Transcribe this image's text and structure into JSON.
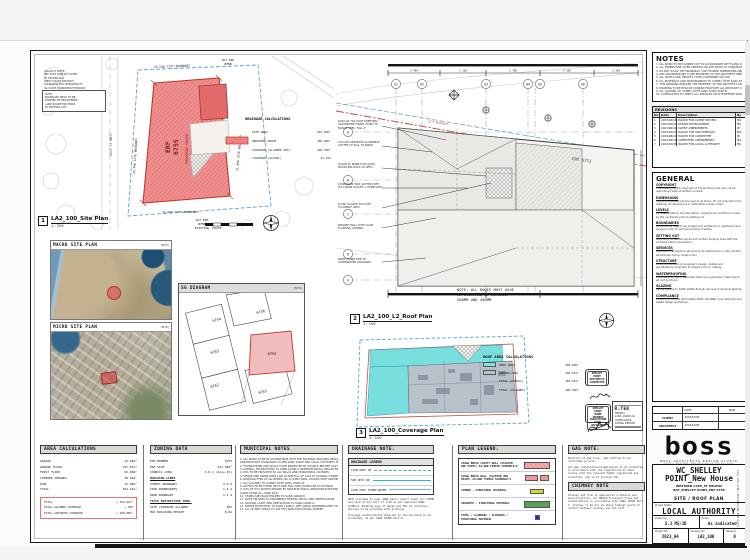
{
  "colors": {
    "accent_red": "#ef8686",
    "red_border": "#c0392b",
    "cyan": "#7fe0e0",
    "gray_area": "#b9c2cb",
    "legend_yellow": "#d6d636",
    "legend_green": "#57a257",
    "legend_blue": "#2929cc",
    "boundary_blue": "#5aa0d8"
  },
  "titleblock": {
    "notes": {
      "title": "NOTES",
      "lines": [
        "1. ALL WORK TO BE CARRIED OUT IN ACCORDANCE WITH SANS 10400 AND THE NBR.",
        "2. ALL DIMENSIONS TO BE VERIFIED ON SITE PRIOR TO CONSTRUCTION.",
        "3. DO NOT SCALE OFF DRAWINGS. USE FIGURED DIMENSIONS ONLY.",
        "4. ANY DISCREPANCIES TO BE REPORTED TO THE ARCHITECT IMMEDIATELY.",
        "5. ALL LEVELS AND HEIGHTS TO BE CONFIRMED ON SITE.",
        "6. ALL MATERIALS AND WORKMANSHIP TO COMPLY WITH SANS SPECIFICATIONS.",
        "7. THIS DRAWING REMAINS THE PROPERTY OF THE ARCHITECT AND MAY NOT BE COPIED.",
        "8. DRAWING TO BE READ IN CONJUNCTION WITH ALL RELEVANT CONSULTANT DRAWINGS.",
        "9. ALL GLAZING TO COMPLY WITH SANS 10400 PART N.",
        "10. CONTRACTOR TO VERIFY ALL SERVICES ON SITE BEFORE WORK COMMENCES."
      ]
    },
    "revisions": {
      "title": "REVISIONS",
      "columns": [
        "No.",
        "Date",
        "Description",
        "By"
      ],
      "rows": [
        [
          "1",
          "2023/04/18",
          "ISSUED FOR CLIENT REVIEW",
          "MS"
        ],
        [
          "2",
          "2023/05/22",
          "DESIGN DEVELOPMENT",
          "MS"
        ],
        [
          "3",
          "2023/06/14",
          "CLIENT AMENDMENTS",
          "JB"
        ],
        [
          "4",
          "2023/07/03",
          "ISSUED FOR SDP APPROVAL",
          "MS"
        ],
        [
          "5",
          "2023/08/21",
          "ISSUED FOR COMMITTEE",
          "JB"
        ],
        [
          "6",
          "2023/09/12",
          "COMMITTEE AMENDMENTS",
          "MS"
        ],
        [
          "7",
          "2023/10/05",
          "ISSUED FOR LOCAL AUTHORITY",
          "MS"
        ]
      ]
    },
    "general": {
      "title": "GENERAL",
      "paras": [
        {
          "h": "COPYRIGHT",
          "b": "This drawing is the copyright of the architect and may not be reproduced without written consent."
        },
        {
          "h": "DIMENSIONS",
          "b": "Figured dimensions to be used at all times. Do not scale from this drawing. All dimensions in millimetres unless noted."
        },
        {
          "h": "LEVELS",
          "b": "All levels relate to the site datum. Levels to be confirmed on site by the contractor prior to setting out."
        },
        {
          "h": "BOUNDARIES",
          "b": "All boundary pegs to be located and verified by a registered land surveyor prior to commencement of works."
        },
        {
          "h": "SETTING OUT",
          "b": "Contractor to set out works and confirm building lines with the architect before excavation."
        },
        {
          "h": "SERVICES",
          "b": "Positions of all existing services to be determined on site. Protect all services during construction."
        },
        {
          "h": "STRUCTURE",
          "b": "All structural work to engineer's design, details and specifications. Engineer to inspect prior to casting."
        },
        {
          "h": "WATERPROOFING",
          "b": "All waterproofing to specialist detail and guarantee. Flashings to all roof junctions."
        },
        {
          "h": "GLAZING",
          "b": "Safety glazing to SANS 10400-N at all doors and low level glazing."
        },
        {
          "h": "COMPLIANCE",
          "b": "All work to comply with SANS 10400, the NBR, local authority and estate design guidelines."
        }
      ],
      "table": {
        "rows": [
          [
            "",
            "DATE",
            "SIGN"
          ],
          [
            "CLIENT",
            "2023/10/05",
            ""
          ],
          [
            "ARCHITECT",
            "2023/10/05",
            ""
          ]
        ]
      }
    },
    "brand": {
      "logo": "boss",
      "tagline": "BOSS ARCHITECTS DESIGN STUDIO",
      "contact": "STUDIO_WESTERN CAPE_INFO@BOSS_082 000 0000"
    },
    "project": {
      "title1": "WC_SHELLEY",
      "title2": "POINT_New House",
      "address1": "WESTERN CAPE_ST HELENA",
      "address2": "BAY_SHELLEY POINT_ERF 6755",
      "sheet_name": "SITE / ROOF PLAN",
      "status_label": "Project Status",
      "status": "LOCAL AUTHORITY",
      "drawn_label": "Drawn by:",
      "drawn": "S.J  MS/JB",
      "scale_label": "Scale:",
      "scale": "As indicated",
      "projno_label": "Project No.",
      "projno": "2023_04",
      "dwgno_label": "Drawing No.",
      "dwgno": "LA2_100",
      "rev_label": "Revision:",
      "rev": "0"
    },
    "side_text": "LA2_100_SITE / ROOF PLAN_ERF 6755"
  },
  "views": {
    "site": {
      "num": "1",
      "name": "LA2_100_Site Plan",
      "scale": "1 : 200",
      "erf": "ERF",
      "erf_no": "6755",
      "erf_sub": "PROPOSED HOUSE",
      "b_top": "16.54m CITY BOUNDARY",
      "b_bottom": "16.66m CITY BOUNDARY",
      "b_left": "25.49m SITE BOUNDARY",
      "b_right": "21.49m SITE BOUNDARY",
      "adj_top1": "ADJ ERF",
      "adj_top2": "6756",
      "adj_bot1": "ADJ ERF",
      "adj_bot2": "6754",
      "adj_bot3": "EXISTING",
      "adj_bot4": "HOUSE",
      "road": "GOLF ST WEST",
      "corner_lines": [
        "LOCALITY NOTE:",
        "ERF 6755 SHELLEY POINT",
        "ST HELENA BAY",
        "WEST COAST DISTRICT",
        "SALDANHA BAY MUNICIPALITY",
        "SG CODE C0660000675500000"
      ],
      "boxed_note": [
        "NOTE:",
        "BOUNDARY PEGS TO BE",
        "VERIFIED BY REGISTERED",
        "LAND SURVEYOR PRIOR",
        "TO SETTING OUT."
      ],
      "legend": {
        "title": "DRAINAGE CALCULATIONS",
        "rows": [
          [
            "SITE AREA",
            "641.00m²"
          ],
          [
            "PROPOSED HOUSE",
            "395.00m²"
          ],
          [
            "COVERAGE (ALLOWED 50%)",
            "320.50m²"
          ],
          [
            "COVERAGE (ACTUAL)",
            "41.07%"
          ]
        ]
      }
    },
    "macro": {
      "title": "MACRO SITE PLAN",
      "nts": "(NTS)"
    },
    "micro": {
      "title": "MICRO SITE PLAN",
      "nts": "(NTS)"
    },
    "sg": {
      "title": "SG DIAGRAM",
      "nts": "(NTS)",
      "parcels": {
        "p1": "6754",
        "p2": "6756",
        "p3": "6763",
        "p4": "6762",
        "p5": "6761",
        "main": "6755"
      }
    },
    "roof": {
      "num": "2",
      "name": "LA2_100_L2_Roof Plan",
      "scale": "1 : 100",
      "note_lines": [
        "NOTE: ALL ROOFS MUST HAVE",
        "AN OVERHANG OF BETWEEN",
        "200MM AND 450MM"
      ],
      "grid_cols": [
        "01",
        "02",
        "03",
        "04",
        "05",
        "06"
      ],
      "grid_rows": [
        "A",
        "B",
        "C",
        "D",
        "E"
      ],
      "erf_label": "ERF 6753",
      "boundary_label": "SITE BOUNDARY",
      "dims": [
        "2 450",
        "3 120",
        "5 780",
        "4 100",
        "2 300"
      ],
      "callouts": [
        [
          "KLIP-LOK 700 ROOF SHEETING,",
          "COLORBOND FINISH, FIXED TO",
          "MANUF. SPEC. FALL 2°"
        ],
        [
          "125x100 SEAMLESS ALUMINIUM",
          "GUTTER TO FALL TO RWDP"
        ],
        [
          "SOLAR PV PANELS ON ALUM.",
          "MOUNTING RAILS TO SPEC."
        ],
        [
          "CONCEALED BOX GUTTER WITH",
          "FULL-BORE OUTLET + OVERFLOW"
        ],
        [
          "FLUSH GLAZED SKYLIGHT",
          "TO MANUF. SPEC."
        ],
        [
          "PARAPET WALL WITH ALUM.",
          "FLASHING CAPPING"
        ],
        [
          "RWDP DOWN PIPE TO",
          "STORMWATER SOAKAWAY"
        ]
      ]
    },
    "coverage": {
      "num": "3",
      "name": "LA2_100_Coverage Plan",
      "scale": "1 : 100"
    },
    "roof_area": {
      "title": "ROOF AREA CALCULATIONS",
      "rows": [
        {
          "sw": "cy",
          "label": "ROOF AREA",
          "value": "258.00m²"
        },
        {
          "sw": "gr",
          "label": "GROUND AREA",
          "value": "136.61m²"
        },
        {
          "sw": "none",
          "label": "TOTAL (ACTUAL)",
          "value": "394.61m²"
        },
        {
          "sw": "none",
          "label": "TOTAL (ALLOWED)",
          "value": "320.50m²"
        }
      ]
    }
  },
  "stamps": {
    "s1": [
      "SHELLEY POINT",
      "AESTHETICS",
      "COMMITTEE"
    ],
    "s2": [
      "SHELLEY POINT",
      "HOME OWNERS",
      "ASSOCIATION",
      "DATE: 2023/10/05"
    ],
    "rtek": {
      "logo": "R:TEK",
      "lines": [
        "ENERGY",
        "SANS 10400-XA",
        "COMPLIANCE",
        "RATING REPORT"
      ]
    }
  },
  "tables": {
    "area": {
      "title": "AREA CALCULATIONS",
      "rows": [
        [
          "GARAGE",
          "44.66m²"
        ],
        [
          "GROUND FLOOR",
          "197.87m²"
        ],
        [
          "FIRST FLOOR",
          "92.08m²"
        ],
        [
          "COVERED VERANDA",
          "38.92m²"
        ],
        [
          "POOL",
          "21.08m²"
        ],
        [
          "TOTAL",
          "394.61m²"
        ]
      ],
      "total_rows": [
        [
          "TOTAL",
          "+ 394.61m²"
        ],
        [
          "TOTAL ALLOWED COVERAGE",
          "+ 50%"
        ],
        [
          "TOTAL ACHIEVED COVERAGE",
          "+ 258.00m²"
        ]
      ]
    },
    "zoning": {
      "title": "ZONING DATA",
      "rows": [
        [
          "ERF NUMBER",
          "6755"
        ],
        [
          "ERF SIZE",
          "641.00m²"
        ],
        [
          "COUNCIL COND.",
          "S.R.1 (Zone 01)"
        ],
        [
          "BUILDING LINES",
          ""
        ],
        [
          "STREET BOUNDARY",
          "3.0 m"
        ],
        [
          "SIDE BOUNDARIES",
          "1.5 m"
        ],
        [
          "REAR BOUNDARY",
          "1.5 m"
        ],
        [
          "TITLE RESTRICTIVE COND.",
          ""
        ],
        [
          "SITE COVERAGE ALLOWED",
          "50%"
        ],
        [
          "MAX BUILDING HEIGHT",
          "8.0m"
        ]
      ]
    },
    "municipal": {
      "title": "MUNICIPAL NOTES",
      "lines": [
        "1. ALL WORK TO BE IN ACCORDANCE WITH THE NATIONAL BUILDING REGULATIONS",
        "AND RELEVANT STANDARDS AS PER SANS 10400 AND LOCAL AUTHORITY BY-LAWS.",
        "2. FOUNDATIONS AND WALLS TO BE INSPECTED BY COUNCIL BEFORE CASTING.",
        "3. OVERALL FOUNDATIONS TO SANS 10400-H (MINIMUM 600mm BELOW NGL).",
        "4. DPC TO BE PROVIDED TO ALL WALLS AND HORIZONTAL COURSES.",
        "5. SEWER AND DRAIN RUNS LAID AT MIN FALL OF 1:60 TO COUNCIL CONNECTION.",
        "6. RODDING EYES AT ALL BENDS, IEs AT JUNCTIONS, GULLIES WITH GRATINGS.",
        "7. ALL GLAZING TO COMPLY WITH SANS 10400-N.",
        "8. GEYSER TO BE FITTED WITH DRIP TRAY AND OVERFLOW TO OUTSIDE.",
        "9. 50% OF HOT WATER DEMAND BY NON-ELECTRICAL RESISTANCE HEATING",
        "(SANS 10400-XA / SANS 204).",
        "10. STAIRS AND BALUSTRADES TO SANS 10400-M.",
        "11. ROOF TRUSSES TO ENGINEER'S DESIGN, DETAIL AND CERTIFICATION.",
        "12. NATURAL LIGHT AND VENTILATION TO SANS 10400-O.",
        "13. SMOKE DETECTORS TO SANS 10400-T. WET AREAS WATERPROOFED TO PART B.",
        "14. ALL OF WET AREAS TO 150 FFLS NON-STRUCTURAL SCREED."
      ]
    },
    "drainage": {
      "title": "DRAINAGE NOTE:",
      "legend_title": "DRAINAGE LEGEND",
      "legend_rows": [
        {
          "label": "110Ø UPVC SP",
          "style": "l-tealdash"
        },
        {
          "label": "50Ø UPVC WP",
          "style": "l-teal"
        },
        {
          "label": "110Ø UPVC STORM WATER",
          "style": "l-blue"
        }
      ],
      "paras": [
        "UPVC drainage to bear SABS mark; invert level min 110MM and laid at min fall of 1:60 as per approved SANS 10400-P. Rodding eyes at bends and IEs at junctions. Gullies to be provided with gratings.",
        "Drainage installations external to the building to be protected, as per SANS 10400 Part P."
      ]
    },
    "plan_legend": {
      "title": "PLAN LEGEND:",
      "rows": [
        {
          "label": "230mm BRICK CAVITY WALL (PLASTER AND PAINT) AS/AND FINISH SCHEDULE/S",
          "sw": "redhatch"
        },
        {
          "label": "110mm BRICK WALL (PLASTER AND PAINT) AS/AND FINISH SCHEDULE/S",
          "sw": "pink"
        },
        {
          "label": "TIMBER - STRUCTURAL MATERIAL",
          "sw": "yellow"
        },
        {
          "label": "CONCRETE - STRUCTURAL MATERIAL",
          "sw": "green"
        },
        {
          "label": "STEEL - CLADDING / FLASHING / STRUCTURAL MATERIAL",
          "sw": "blue"
        }
      ]
    },
    "gas": {
      "title": "GAS NOTE:",
      "paras": [
        "Position of gas line — gas bottles to be confirmed on site.",
        "All gas installations/appliances to be installed in accordance with the regulations at hand. Liaise with the relevant SAQCC registered gas installer, who is to provide COC."
      ],
      "chimney_title": "CHIMNEY NOTE",
      "chimney_para": "Chimney and flue to specialist's details and specifications, all BRAAI/fireplace flues and installations in accordance with SANS 10400 Part V. Chimney to be min 1m above highest point of contact between chimney and the roof."
    }
  }
}
